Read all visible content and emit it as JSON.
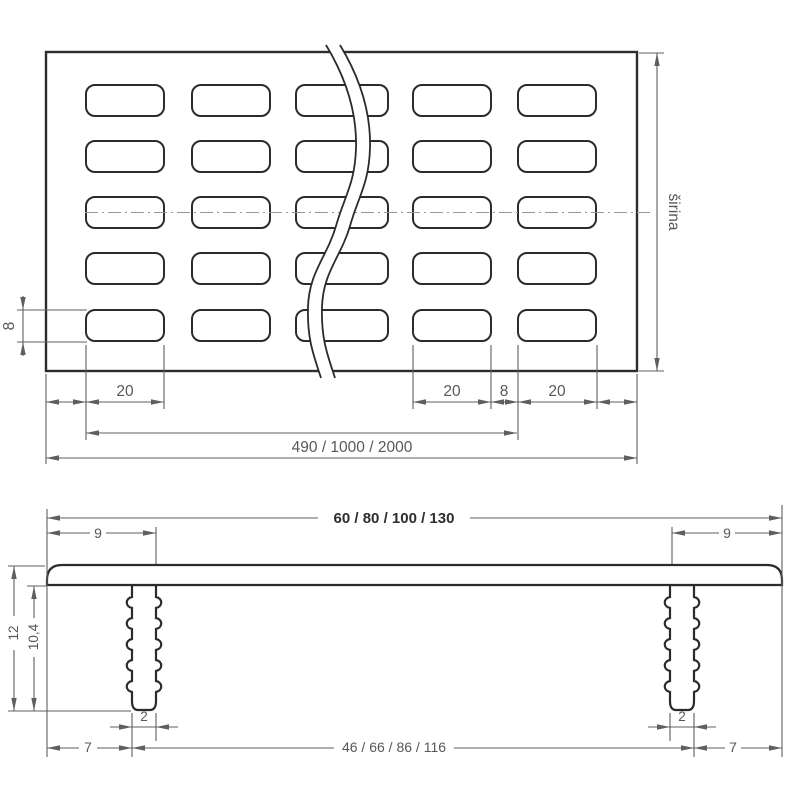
{
  "top_view": {
    "hole_height": "8",
    "width_label": "širina",
    "hole_width_1": "20",
    "hole_width_2": "20",
    "hole_pitch_gap": "8",
    "hole_width_3": "20",
    "length_options": "490 / 1000 / 2000"
  },
  "section_view": {
    "width_options": "60 / 80 / 100 / 130",
    "edge_offset_left": "9",
    "edge_offset_right": "9",
    "total_height": "12",
    "leg_height": "10,4",
    "leg_width_left": "2",
    "leg_width_right": "2",
    "leg_inset_left": "7",
    "leg_inset_right": "7",
    "leg_span_options": "46 / 66 / 86 / 116"
  }
}
